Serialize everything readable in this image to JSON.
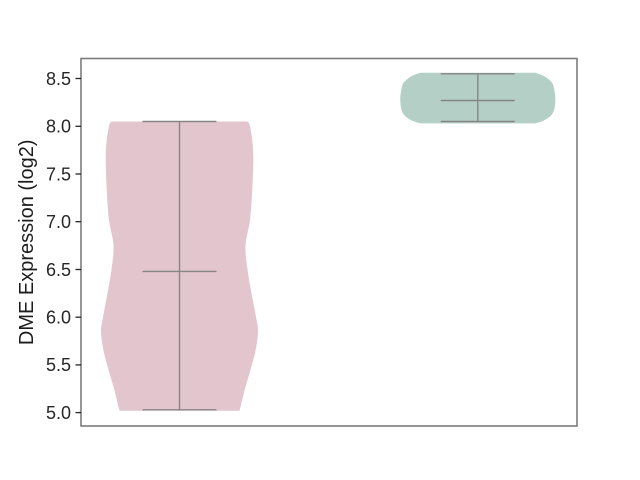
{
  "chart_data": {
    "type": "violin",
    "title": "",
    "xlabel": "",
    "ylabel": "DME Expression (log2)",
    "ylim": [
      4.86,
      8.71
    ],
    "yticks": [
      "5.0",
      "5.5",
      "6.0",
      "6.5",
      "7.0",
      "7.5",
      "8.0",
      "8.5"
    ],
    "xtick_labels_visible": false,
    "grid": false,
    "legend": "none",
    "frame_color": "#7c7c7c",
    "inner_line_color": "#868686",
    "tick_color": "#262626",
    "cap_halfwidth_px": 37,
    "categories": [
      "",
      ""
    ],
    "series": [
      {
        "name": "violin-left-pink",
        "fill": "#e3c6cd",
        "x_fraction": 0.1986,
        "box": {
          "whisker_min": 5.03,
          "median": 6.48,
          "whisker_max": 8.05
        },
        "outline": [
          [
            8.05,
            67.0
          ],
          [
            8.02,
            70.0
          ],
          [
            7.85,
            72.8
          ],
          [
            7.68,
            73.8
          ],
          [
            7.45,
            73.3
          ],
          [
            7.2,
            72.0
          ],
          [
            7.0,
            70.3
          ],
          [
            6.75,
            66.0
          ],
          [
            6.5,
            68.0
          ],
          [
            6.25,
            72.0
          ],
          [
            6.0,
            76.5
          ],
          [
            5.85,
            78.5
          ],
          [
            5.65,
            76.0
          ],
          [
            5.45,
            71.0
          ],
          [
            5.24,
            65.2
          ],
          [
            5.07,
            61.2
          ],
          [
            5.02,
            60.0
          ]
        ]
      },
      {
        "name": "violin-right-green",
        "fill": "#b4cfc5",
        "x_fraction": 0.8,
        "box": {
          "whisker_min": 8.05,
          "median": 8.27,
          "whisker_max": 8.55
        },
        "outline": [
          [
            8.56,
            57.5
          ],
          [
            8.52,
            67.0
          ],
          [
            8.45,
            74.5
          ],
          [
            8.35,
            77.0
          ],
          [
            8.27,
            77.5
          ],
          [
            8.18,
            76.5
          ],
          [
            8.11,
            73.0
          ],
          [
            8.06,
            66.0
          ],
          [
            8.03,
            57.5
          ]
        ]
      }
    ]
  }
}
